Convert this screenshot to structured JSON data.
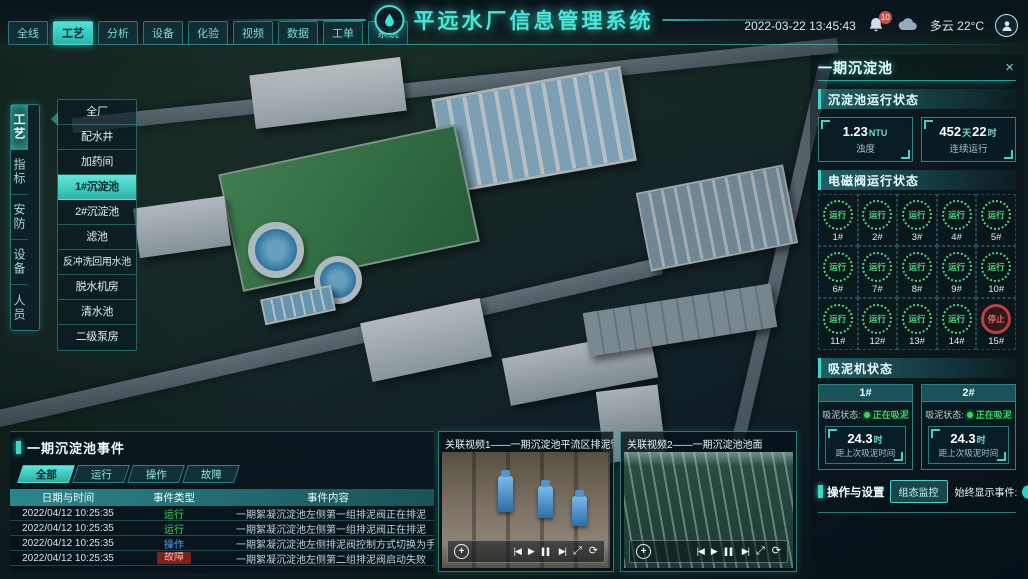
{
  "colors": {
    "accent": "#3fd6c9",
    "run_green": "#35d95f",
    "op_blue": "#4aa0ff",
    "fault_red": "#7c211c",
    "stop_red": "#b84040"
  },
  "header": {
    "title": "平远水厂信息管理系统",
    "datetime": "2022-03-22 13:45:43",
    "alarm_badge": "10",
    "weather": "多云 22°C",
    "nav": [
      {
        "label": "全线",
        "state": "normal"
      },
      {
        "label": "工艺",
        "state": "active"
      },
      {
        "label": "分析",
        "state": "normal"
      },
      {
        "label": "设备",
        "state": "normal"
      },
      {
        "label": "化验",
        "state": "normal"
      },
      {
        "label": "视频",
        "state": "normal"
      },
      {
        "label": "数据",
        "state": "normal"
      },
      {
        "label": "工单",
        "state": "normal"
      },
      {
        "label": "系统",
        "state": "normal"
      }
    ]
  },
  "left_menu": {
    "items": [
      {
        "label": "工艺",
        "state": "active"
      },
      {
        "label": "指标",
        "state": "normal"
      },
      {
        "label": "安防",
        "state": "normal"
      },
      {
        "label": "设备",
        "state": "normal"
      },
      {
        "label": "人员",
        "state": "normal"
      }
    ]
  },
  "submenu": {
    "items": [
      {
        "label": "全厂",
        "state": "normal"
      },
      {
        "label": "配水井",
        "state": "normal"
      },
      {
        "label": "加药间",
        "state": "normal"
      },
      {
        "label": "1#沉淀池",
        "state": "active"
      },
      {
        "label": "2#沉淀池",
        "state": "normal"
      },
      {
        "label": "滤池",
        "state": "normal"
      },
      {
        "label": "反冲洗回用水池",
        "state": "normal"
      },
      {
        "label": "脱水机房",
        "state": "normal"
      },
      {
        "label": "清水池",
        "state": "normal"
      },
      {
        "label": "二级泵房",
        "state": "normal"
      }
    ]
  },
  "events_panel": {
    "title": "一期沉淀池事件",
    "tabs": [
      {
        "label": "全部",
        "state": "active"
      },
      {
        "label": "运行",
        "state": "normal"
      },
      {
        "label": "操作",
        "state": "normal"
      },
      {
        "label": "故障",
        "state": "normal"
      }
    ],
    "columns": [
      "日期与时间",
      "事件类型",
      "事件内容"
    ],
    "rows": [
      {
        "time": "2022/04/12 10:25:35",
        "type": "运行",
        "state": "run",
        "content": "一期絮凝沉淀池左侧第一组排泥阀正在排泥"
      },
      {
        "time": "2022/04/12 10:25:35",
        "type": "运行",
        "state": "run",
        "content": "一期絮凝沉淀池左侧第一组排泥阀正在排泥"
      },
      {
        "time": "2022/04/12 10:25:35",
        "type": "操作",
        "state": "op",
        "content": "一期絮凝沉淀池左侧排泥阀控制方式切换为手动"
      },
      {
        "time": "2022/04/12 10:25:35",
        "type": "故障",
        "state": "fault",
        "content": "一期絮凝沉淀池左侧第二组排泥阀启动失败"
      }
    ]
  },
  "videos": [
    {
      "title": "关联视频1——一期沉淀池平流区排泥管廊"
    },
    {
      "title": "关联视频2——一期沉淀池池面"
    }
  ],
  "right_panel": {
    "title": "一期沉淀池",
    "close": "×",
    "pool_status": {
      "title": "沉淀池运行状态",
      "stats": [
        {
          "v1": "1.23",
          "u1": "NTU",
          "label": "浊度"
        },
        {
          "v1": "452",
          "u1": "天",
          "v2": "22",
          "u2": "时",
          "label": "连续运行"
        }
      ]
    },
    "valves": {
      "title": "电磁阀运行状态",
      "items": [
        {
          "id": "1#",
          "status": "运行",
          "state": "run"
        },
        {
          "id": "2#",
          "status": "运行",
          "state": "run"
        },
        {
          "id": "3#",
          "status": "运行",
          "state": "run"
        },
        {
          "id": "4#",
          "status": "运行",
          "state": "run"
        },
        {
          "id": "5#",
          "status": "运行",
          "state": "run"
        },
        {
          "id": "6#",
          "status": "运行",
          "state": "run"
        },
        {
          "id": "7#",
          "status": "运行",
          "state": "run"
        },
        {
          "id": "8#",
          "status": "运行",
          "state": "run"
        },
        {
          "id": "9#",
          "status": "运行",
          "state": "run"
        },
        {
          "id": "10#",
          "status": "运行",
          "state": "run"
        },
        {
          "id": "11#",
          "status": "运行",
          "state": "run"
        },
        {
          "id": "12#",
          "status": "运行",
          "state": "run"
        },
        {
          "id": "13#",
          "status": "运行",
          "state": "run"
        },
        {
          "id": "14#",
          "status": "运行",
          "state": "run"
        },
        {
          "id": "15#",
          "status": "停止",
          "state": "stop"
        }
      ]
    },
    "mud": {
      "title": "吸泥机状态",
      "machines": [
        {
          "id": "1#",
          "status_label": "吸泥状态:",
          "status": "正在吸泥",
          "value": "24.3",
          "unit": "时",
          "label": "距上次吸泥时间"
        },
        {
          "id": "2#",
          "status_label": "吸泥状态:",
          "status": "正在吸泥",
          "value": "24.3",
          "unit": "时",
          "label": "距上次吸泥时间"
        }
      ]
    },
    "operations": {
      "title": "操作与设置",
      "button": "组态监控",
      "toggle_label": "始终显示事件:",
      "toggle_state": "on"
    }
  }
}
